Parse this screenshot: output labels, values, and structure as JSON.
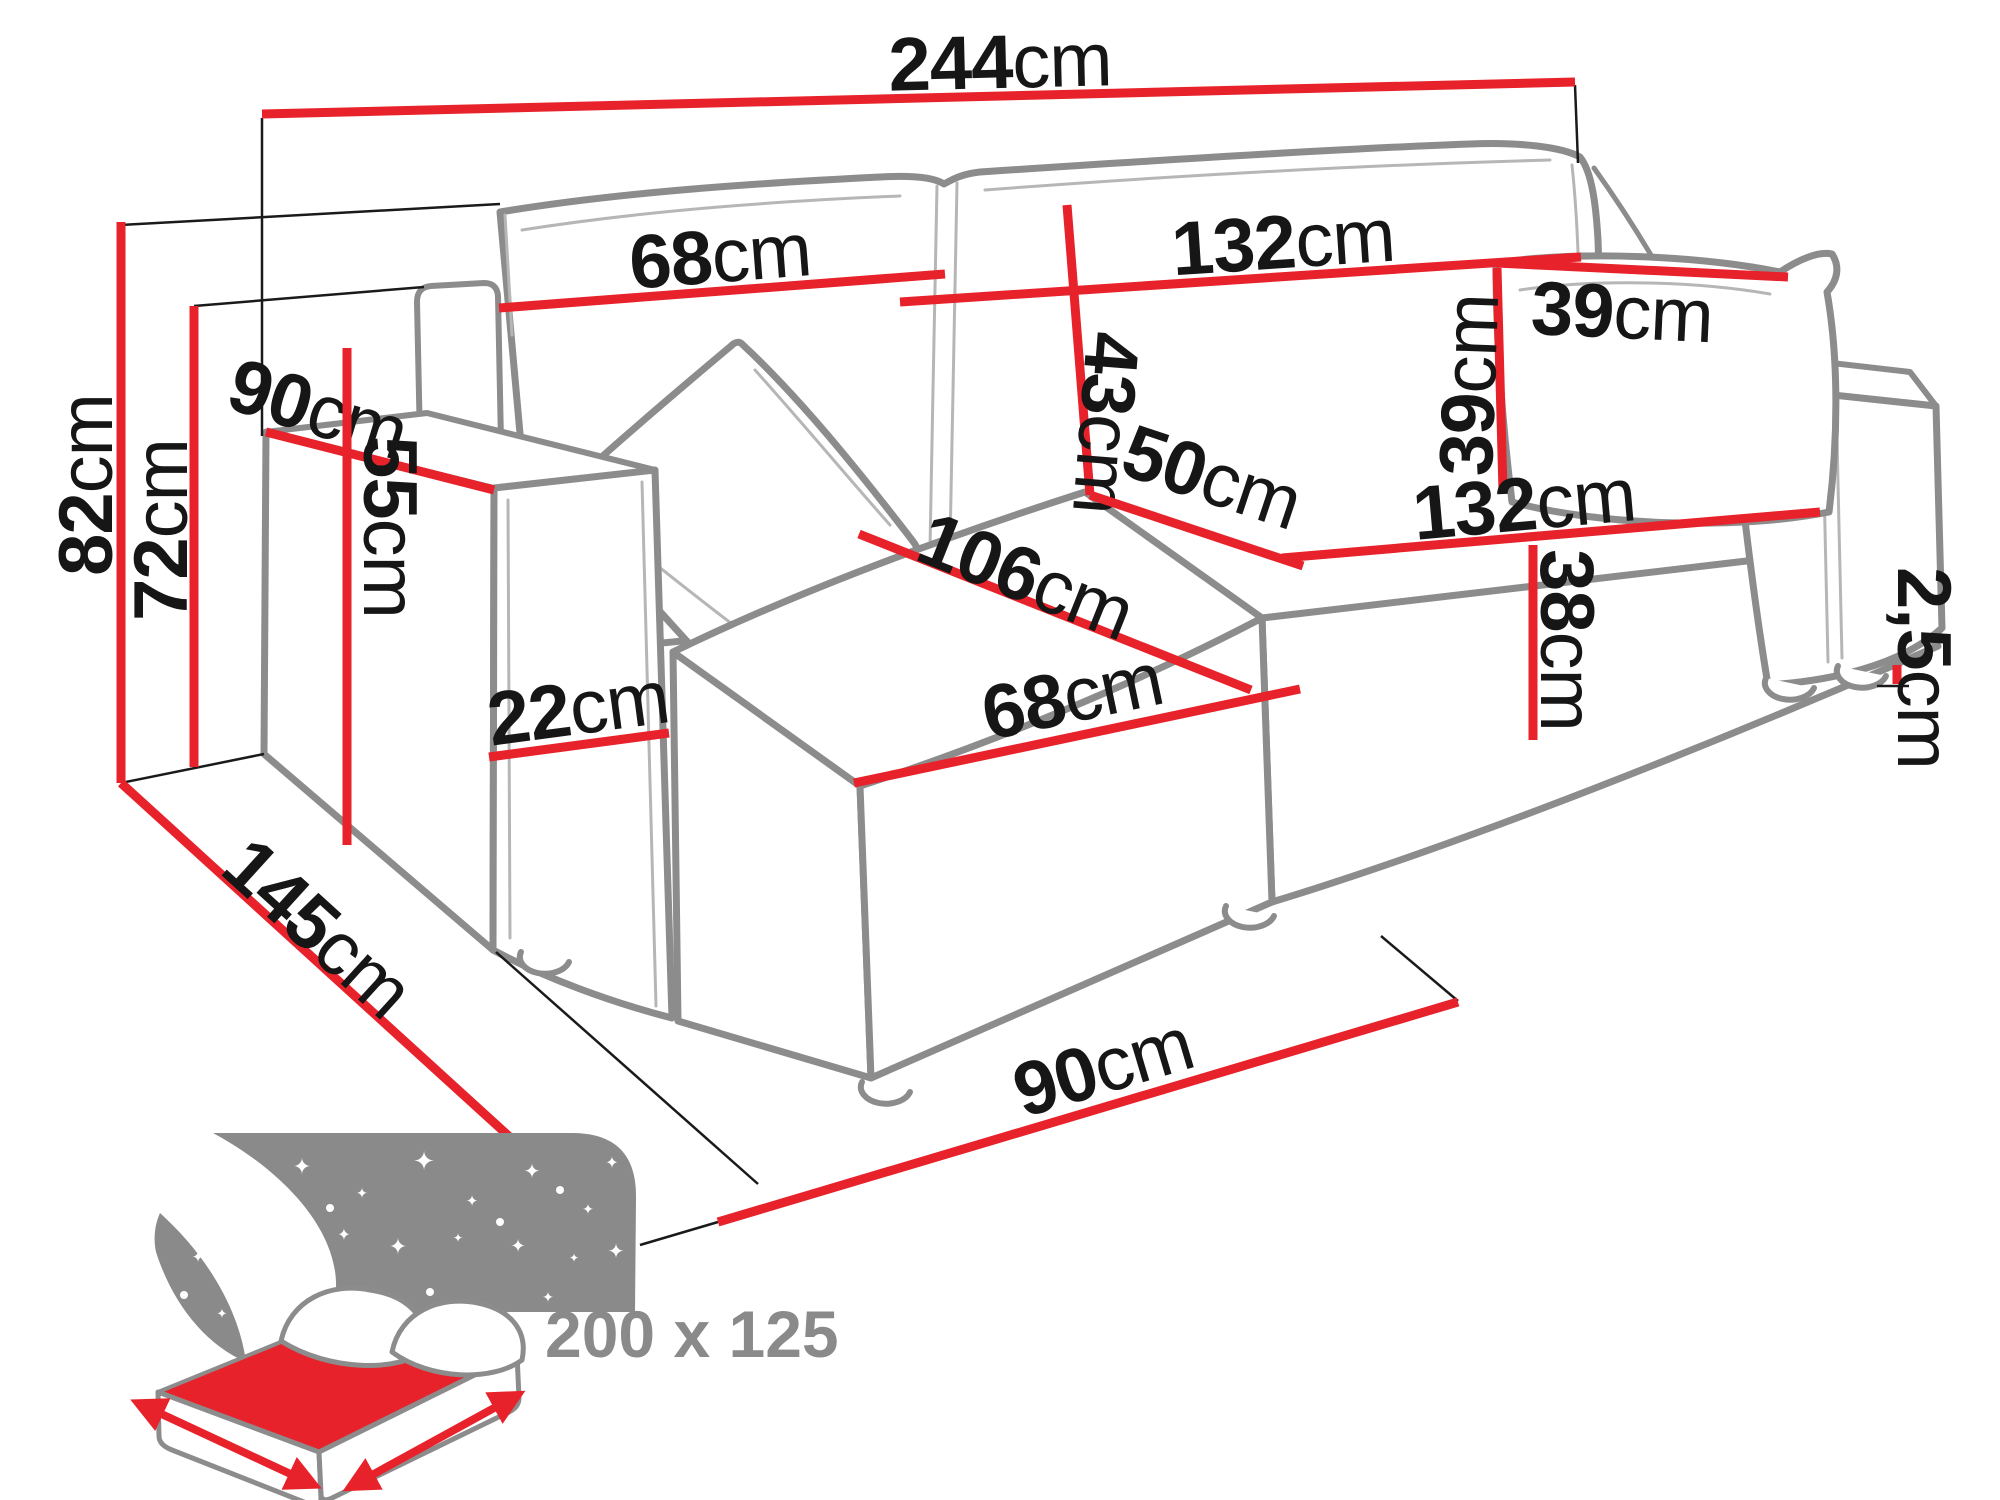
{
  "colors": {
    "dimension_red": "#e8222a",
    "label_black": "#161616",
    "sofa_outline_gray": "#8c8c8c",
    "seam_gray": "#b6b6b6",
    "icon_gray": "#8a8a8a"
  },
  "dimensions": {
    "total_width": {
      "num": "244",
      "unit": "cm"
    },
    "backrest_left_width": {
      "num": "68",
      "unit": "cm"
    },
    "backrest_right_width": {
      "num": "132",
      "unit": "cm"
    },
    "backrest_height": {
      "num": "43",
      "unit": "cm"
    },
    "cushion_width": {
      "num": "39",
      "unit": "cm"
    },
    "cushion_height": {
      "num": "39",
      "unit": "cm"
    },
    "armrest_depth": {
      "num": "90",
      "unit": "cm"
    },
    "total_height": {
      "num": "82",
      "unit": "cm"
    },
    "back_frame_height": {
      "num": "72",
      "unit": "cm"
    },
    "armrest_height": {
      "num": "55",
      "unit": "cm"
    },
    "armrest_width": {
      "num": "22",
      "unit": "cm"
    },
    "seat_back_depth": {
      "num": "50",
      "unit": "cm"
    },
    "chaise_length": {
      "num": "106",
      "unit": "cm"
    },
    "chaise_width": {
      "num": "68",
      "unit": "cm"
    },
    "seat_width": {
      "num": "132",
      "unit": "cm"
    },
    "seat_front_height": {
      "num": "38",
      "unit": "cm"
    },
    "leg_height": {
      "num": "2,5",
      "unit": "cm"
    },
    "total_depth": {
      "num": "145",
      "unit": "cm"
    },
    "chaise_floor_width": {
      "num": "90",
      "unit": "cm"
    }
  },
  "sleeping_area": {
    "label": "200 x 125"
  }
}
